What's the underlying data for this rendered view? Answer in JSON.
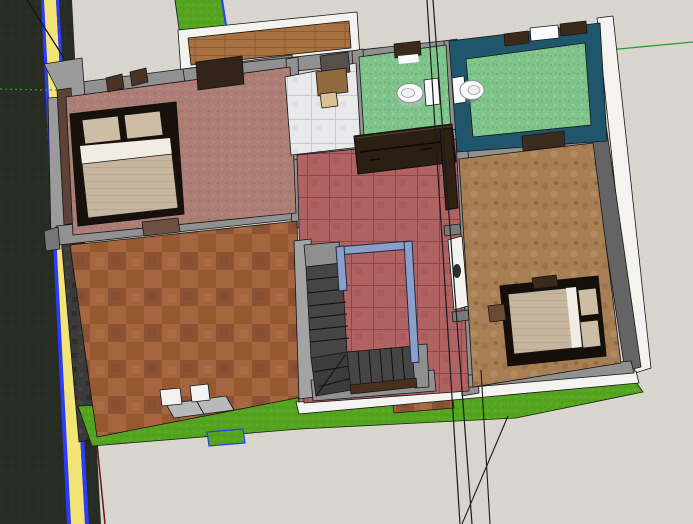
{
  "app": {
    "name": "3d-modeler-viewport",
    "view": "top-down house floor-plan model",
    "visible_text": "none"
  },
  "colors": {
    "pavement": "#d9d6d0",
    "pavement_dot": "#cfccc6",
    "road": "#272c25",
    "road_dot": "#343831",
    "lane_yellow": "#f2e476",
    "selection_blue": "#2b3bff",
    "grass": "#55a520",
    "grass_dark": "#479417",
    "grass_light": "#66b52e",
    "wall_cap": "#919191",
    "wall_cap_dark": "#757575",
    "wall_white": "#f5f3ef",
    "wall_dark_face": "#646464",
    "stairs_side_gray": "#a3a3a3",
    "carpet": "#ac7e75",
    "carpet_dark": "#9d7068",
    "terracotta_a": "#a5653e",
    "terracotta_b": "#8d5233",
    "red_tile": "#b16363",
    "red_tile_line": "#8c4848",
    "brown_floor": "#a87e55",
    "brown_floor_dark": "#99714a",
    "green_tile": "#7fc48b",
    "green_tile_dark": "#6cb077",
    "marble": "#e9e9eb",
    "marble_line": "#c9c9cf",
    "wood_balcony": "#a9713f",
    "wood_line": "#8d5c31",
    "teal_wall": "#20566b",
    "dark_compound_wall": "#3a3a38",
    "dark_compound_blotch": "#2e2e2c",
    "bed_frame": "#17100b",
    "mattress": "#c6b69f",
    "pillow": "#cdbda4",
    "sheet_white": "#f1ede4",
    "sideboard_brown": "#2b1e12",
    "door_header_brown": "#3b2a1a",
    "open_door_brown": "#2e2013",
    "bench_brown": "#6e4f41",
    "desk_brown": "#8f6b3e",
    "desk_top": "#57504a",
    "stool_tan": "#d9c193",
    "nightstand_brown": "#6b4a35",
    "bedroom_west_wall_brown": "#5d4237",
    "stair_dark": "#454545",
    "stair_winder": "#3c3c3c",
    "stair_landing": "#8f8f8f",
    "railing_blue": "#8aa0c8",
    "railing_edge": "#1c2b4a",
    "toilet_white": "#fafafa",
    "door_white": "#f4f2ee",
    "axis_green": "#2e9b2e",
    "boundary_red": "#6a1515",
    "threshold_brown": "#4a2f1c",
    "guide_line": "#1c1c1c",
    "shoe_white": "#f2f2f2",
    "shoe_slab_gray": "#b9b9b9"
  },
  "selection": {
    "selected_entities": [
      "road-center-line",
      "lawn-notch"
    ],
    "highlight_color": "#2b3bff"
  },
  "scene": {
    "objects": [
      "road",
      "road-center-line",
      "sidewalk",
      "front-lawn",
      "lawn-notch",
      "compound-wall",
      "house",
      "front-balcony",
      "side-balcony",
      "master-bedroom",
      "master-bed",
      "wardrobe",
      "bench",
      "lobby",
      "study-desk",
      "stool",
      "bathroom-1",
      "toilet-1",
      "bathroom-2",
      "toilet-2",
      "living-room",
      "sideboard",
      "staircase",
      "stair-railing",
      "open-door",
      "white-door",
      "bedroom-2",
      "bed-2",
      "nightstand",
      "terrace",
      "step-stones",
      "entry-step",
      "garden-path",
      "drawing-axis-red-dotted",
      "drawing-axis-green",
      "guide-lines"
    ]
  }
}
